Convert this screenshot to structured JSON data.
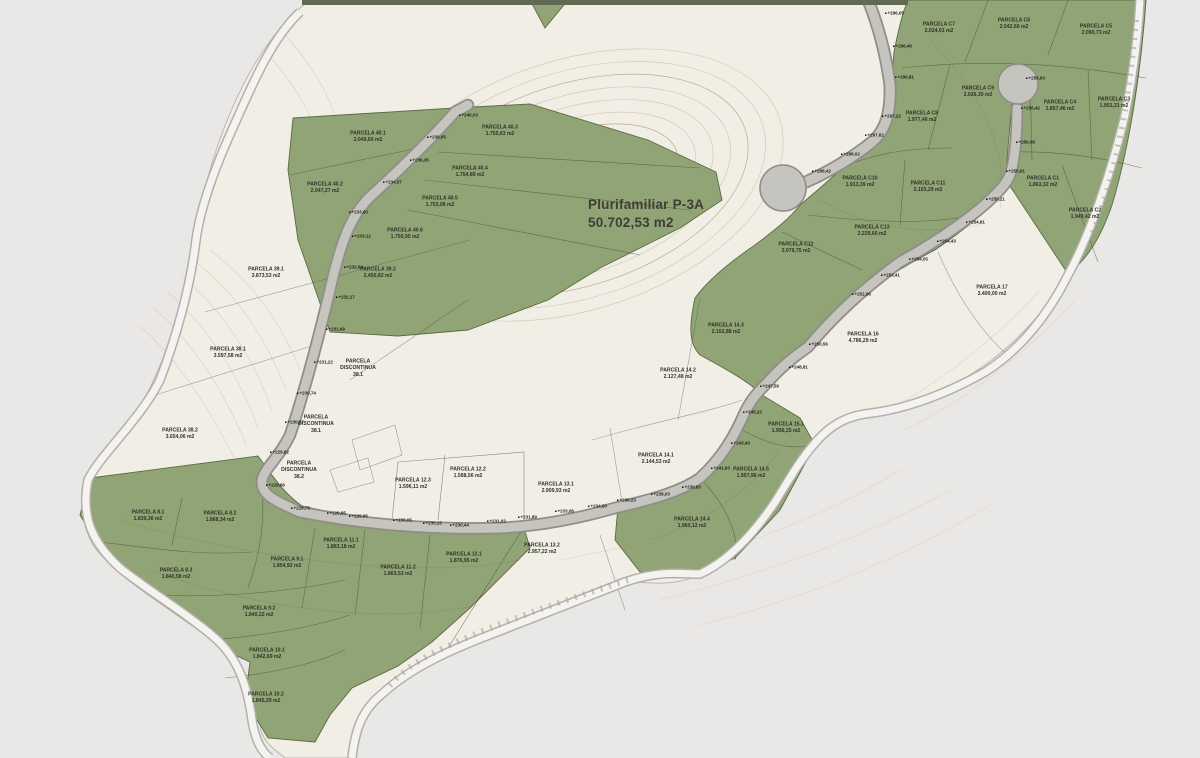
{
  "map": {
    "title": {
      "line1": "Plurifamiliar P-3A",
      "line2": "50.702,53 m2"
    },
    "colors": {
      "background": "#e9e8e6",
      "terrain": "#f1eee5",
      "parcel_green": "#90a475",
      "parcel_green_border": "#5b6a44",
      "road_fill": "#c6c4bf",
      "road_edge": "#8f8d88",
      "boundary_road": "#f6f5f2",
      "contour": "#d8ccb8",
      "label_text": "#2e332a"
    },
    "parcel_labels": [
      {
        "lines": [
          "PARCELA 40.1",
          "2.049,60 m2"
        ],
        "x": 368,
        "y": 137
      },
      {
        "lines": [
          "PARCELA 40.2",
          "2.047,27 m2"
        ],
        "x": 325,
        "y": 188
      },
      {
        "lines": [
          "PARCELA 40.3",
          "1.755,63 m2"
        ],
        "x": 500,
        "y": 131
      },
      {
        "lines": [
          "PARCELA 40.4",
          "1.754,89 m2"
        ],
        "x": 470,
        "y": 172
      },
      {
        "lines": [
          "PARCELA 40.5",
          "1.753,08 m2"
        ],
        "x": 440,
        "y": 202
      },
      {
        "lines": [
          "PARCELA 40.6",
          "1.750,95 m2"
        ],
        "x": 405,
        "y": 234
      },
      {
        "lines": [
          "PARCELA 39.1",
          "3.873,53 m2"
        ],
        "x": 266,
        "y": 273
      },
      {
        "lines": [
          "PARCELA 39.2",
          "2.450,82 m2"
        ],
        "x": 378,
        "y": 273
      },
      {
        "lines": [
          "PARCELA 38.1",
          "3.597,58 m2"
        ],
        "x": 228,
        "y": 353
      },
      {
        "lines": [
          "PARCELA 38.2",
          "3.654,06 m2"
        ],
        "x": 180,
        "y": 434
      },
      {
        "lines": [
          "PARCELA",
          "DISCONTINUA",
          "38.1"
        ],
        "x": 358,
        "y": 368
      },
      {
        "lines": [
          "PARCELA",
          "DISCONTINUA",
          "38.1"
        ],
        "x": 316,
        "y": 424
      },
      {
        "lines": [
          "PARCELA",
          "DISCONTINUA",
          "38.2"
        ],
        "x": 299,
        "y": 470
      },
      {
        "lines": [
          "PARCELA 8.1",
          "1.839,36 m2"
        ],
        "x": 148,
        "y": 516
      },
      {
        "lines": [
          "PARCELA 8.2",
          "1.868,34 m2"
        ],
        "x": 220,
        "y": 517
      },
      {
        "lines": [
          "PARCELA 8.3",
          "1.840,58 m2"
        ],
        "x": 176,
        "y": 574
      },
      {
        "lines": [
          "PARCELA 9.1",
          "1.854,92 m2"
        ],
        "x": 287,
        "y": 563
      },
      {
        "lines": [
          "PARCELA 9.2",
          "1.840,22 m2"
        ],
        "x": 259,
        "y": 612
      },
      {
        "lines": [
          "PARCELA 10.1",
          "1.842,69 m2"
        ],
        "x": 267,
        "y": 654
      },
      {
        "lines": [
          "PARCELA 10.2",
          "1.845,29 m2"
        ],
        "x": 266,
        "y": 698
      },
      {
        "lines": [
          "PARCELA 11.1",
          "1.863,18 m2"
        ],
        "x": 341,
        "y": 544
      },
      {
        "lines": [
          "PARCELA 11.2",
          "1.863,53 m2"
        ],
        "x": 398,
        "y": 571
      },
      {
        "lines": [
          "PARCELA 12.1",
          "1.876,95 m2"
        ],
        "x": 464,
        "y": 558
      },
      {
        "lines": [
          "PARCELA 12.2",
          "1.588,56 m2"
        ],
        "x": 468,
        "y": 473
      },
      {
        "lines": [
          "PARCELA 12.3",
          "1.596,11 m2"
        ],
        "x": 413,
        "y": 484
      },
      {
        "lines": [
          "PARCELA 13.1",
          "2.909,93 m2"
        ],
        "x": 556,
        "y": 488
      },
      {
        "lines": [
          "PARCELA 13.2",
          "2.957,22 m2"
        ],
        "x": 542,
        "y": 549
      },
      {
        "lines": [
          "PARCELA 14.1",
          "2.144,53 m2"
        ],
        "x": 656,
        "y": 459
      },
      {
        "lines": [
          "PARCELA 14.2",
          "2.127,48 m2"
        ],
        "x": 678,
        "y": 374
      },
      {
        "lines": [
          "PARCELA 14.3",
          "2.152,88 m2"
        ],
        "x": 726,
        "y": 329
      },
      {
        "lines": [
          "PARCELA 14.4",
          "1.960,12 m2"
        ],
        "x": 692,
        "y": 523
      },
      {
        "lines": [
          "PARCELA 14.5",
          "1.957,96 m2"
        ],
        "x": 751,
        "y": 473
      },
      {
        "lines": [
          "PARCELA 15.1",
          "1.956,25 m2"
        ],
        "x": 786,
        "y": 428
      },
      {
        "lines": [
          "PARCELA 16",
          "4.786,29 m2"
        ],
        "x": 863,
        "y": 338
      },
      {
        "lines": [
          "PARCELA 17",
          "3.400,00 m2"
        ],
        "x": 992,
        "y": 291
      },
      {
        "lines": [
          "PARCELA C1",
          "1.863,32 m2"
        ],
        "x": 1043,
        "y": 182
      },
      {
        "lines": [
          "PARCELA C2",
          "1.949,42 m2"
        ],
        "x": 1085,
        "y": 214
      },
      {
        "lines": [
          "PARCELA C3",
          "1.951,31 m2"
        ],
        "x": 1114,
        "y": 103
      },
      {
        "lines": [
          "PARCELA C4",
          "1.857,46 m2"
        ],
        "x": 1060,
        "y": 106
      },
      {
        "lines": [
          "PARCELA C5",
          "2.090,73 m2"
        ],
        "x": 1096,
        "y": 30
      },
      {
        "lines": [
          "PARCELA C6",
          "2.042,60 m2"
        ],
        "x": 1014,
        "y": 24
      },
      {
        "lines": [
          "PARCELA C7",
          "2.024,01 m2"
        ],
        "x": 939,
        "y": 28
      },
      {
        "lines": [
          "PARCELA C8",
          "1.977,46 m2"
        ],
        "x": 922,
        "y": 117
      },
      {
        "lines": [
          "PARCELA C9",
          "2.026,30 m2"
        ],
        "x": 978,
        "y": 92
      },
      {
        "lines": [
          "PARCELA C10",
          "1.913,39 m2"
        ],
        "x": 860,
        "y": 182
      },
      {
        "lines": [
          "PARCELA C11",
          "2.103,29 m2"
        ],
        "x": 928,
        "y": 187
      },
      {
        "lines": [
          "PARCELA C12",
          "2.079,75 m2"
        ],
        "x": 796,
        "y": 248
      },
      {
        "lines": [
          "PARCELA C13",
          "2.229,60 m2"
        ],
        "x": 872,
        "y": 231
      }
    ],
    "elevation_marks": [
      {
        "t": "+240,03",
        "x": 459,
        "y": 115
      },
      {
        "t": "+238,05",
        "x": 427,
        "y": 137
      },
      {
        "t": "+236,35",
        "x": 410,
        "y": 160
      },
      {
        "t": "+234,57",
        "x": 383,
        "y": 182
      },
      {
        "t": "+233,60",
        "x": 349,
        "y": 212
      },
      {
        "t": "+233,12",
        "x": 352,
        "y": 236
      },
      {
        "t": "+232,64",
        "x": 344,
        "y": 267
      },
      {
        "t": "+232,17",
        "x": 336,
        "y": 297
      },
      {
        "t": "+231,69",
        "x": 326,
        "y": 329
      },
      {
        "t": "+231,22",
        "x": 314,
        "y": 362
      },
      {
        "t": "+230,74",
        "x": 297,
        "y": 393
      },
      {
        "t": "+230,27",
        "x": 285,
        "y": 422
      },
      {
        "t": "+229,82",
        "x": 270,
        "y": 452
      },
      {
        "t": "+229,66",
        "x": 266,
        "y": 485
      },
      {
        "t": "+229,75",
        "x": 291,
        "y": 508
      },
      {
        "t": "+229,85",
        "x": 327,
        "y": 513
      },
      {
        "t": "+229,95",
        "x": 349,
        "y": 516
      },
      {
        "t": "+230,05",
        "x": 393,
        "y": 520
      },
      {
        "t": "+230,15",
        "x": 423,
        "y": 523
      },
      {
        "t": "+230,44",
        "x": 450,
        "y": 525
      },
      {
        "t": "+231,02",
        "x": 487,
        "y": 521
      },
      {
        "t": "+231,89",
        "x": 518,
        "y": 517
      },
      {
        "t": "+233,06",
        "x": 555,
        "y": 511
      },
      {
        "t": "+234,50",
        "x": 588,
        "y": 506
      },
      {
        "t": "+236,23",
        "x": 617,
        "y": 500
      },
      {
        "t": "+238,03",
        "x": 651,
        "y": 494
      },
      {
        "t": "+239,83",
        "x": 682,
        "y": 487
      },
      {
        "t": "+241,63",
        "x": 711,
        "y": 468
      },
      {
        "t": "+243,43",
        "x": 731,
        "y": 443
      },
      {
        "t": "+245,23",
        "x": 743,
        "y": 412
      },
      {
        "t": "+247,59",
        "x": 760,
        "y": 386
      },
      {
        "t": "+248,81",
        "x": 789,
        "y": 367
      },
      {
        "t": "+250,56",
        "x": 809,
        "y": 344
      },
      {
        "t": "+252,96",
        "x": 852,
        "y": 294
      },
      {
        "t": "+253,41",
        "x": 881,
        "y": 275
      },
      {
        "t": "+254,05",
        "x": 909,
        "y": 259
      },
      {
        "t": "+254,43",
        "x": 937,
        "y": 241
      },
      {
        "t": "+254,81",
        "x": 966,
        "y": 222
      },
      {
        "t": "+255,21",
        "x": 986,
        "y": 199
      },
      {
        "t": "+255,61",
        "x": 1006,
        "y": 171
      },
      {
        "t": "+256,08",
        "x": 1016,
        "y": 142
      },
      {
        "t": "+256,42",
        "x": 1021,
        "y": 108
      },
      {
        "t": "+256,63",
        "x": 1026,
        "y": 78
      },
      {
        "t": "+296,05",
        "x": 885,
        "y": 13
      },
      {
        "t": "+296,46",
        "x": 893,
        "y": 46
      },
      {
        "t": "+296,81",
        "x": 895,
        "y": 77
      },
      {
        "t": "+297,22",
        "x": 882,
        "y": 116
      },
      {
        "t": "+297,62",
        "x": 865,
        "y": 135
      },
      {
        "t": "+298,02",
        "x": 841,
        "y": 154
      },
      {
        "t": "+298,42",
        "x": 812,
        "y": 171
      }
    ]
  }
}
